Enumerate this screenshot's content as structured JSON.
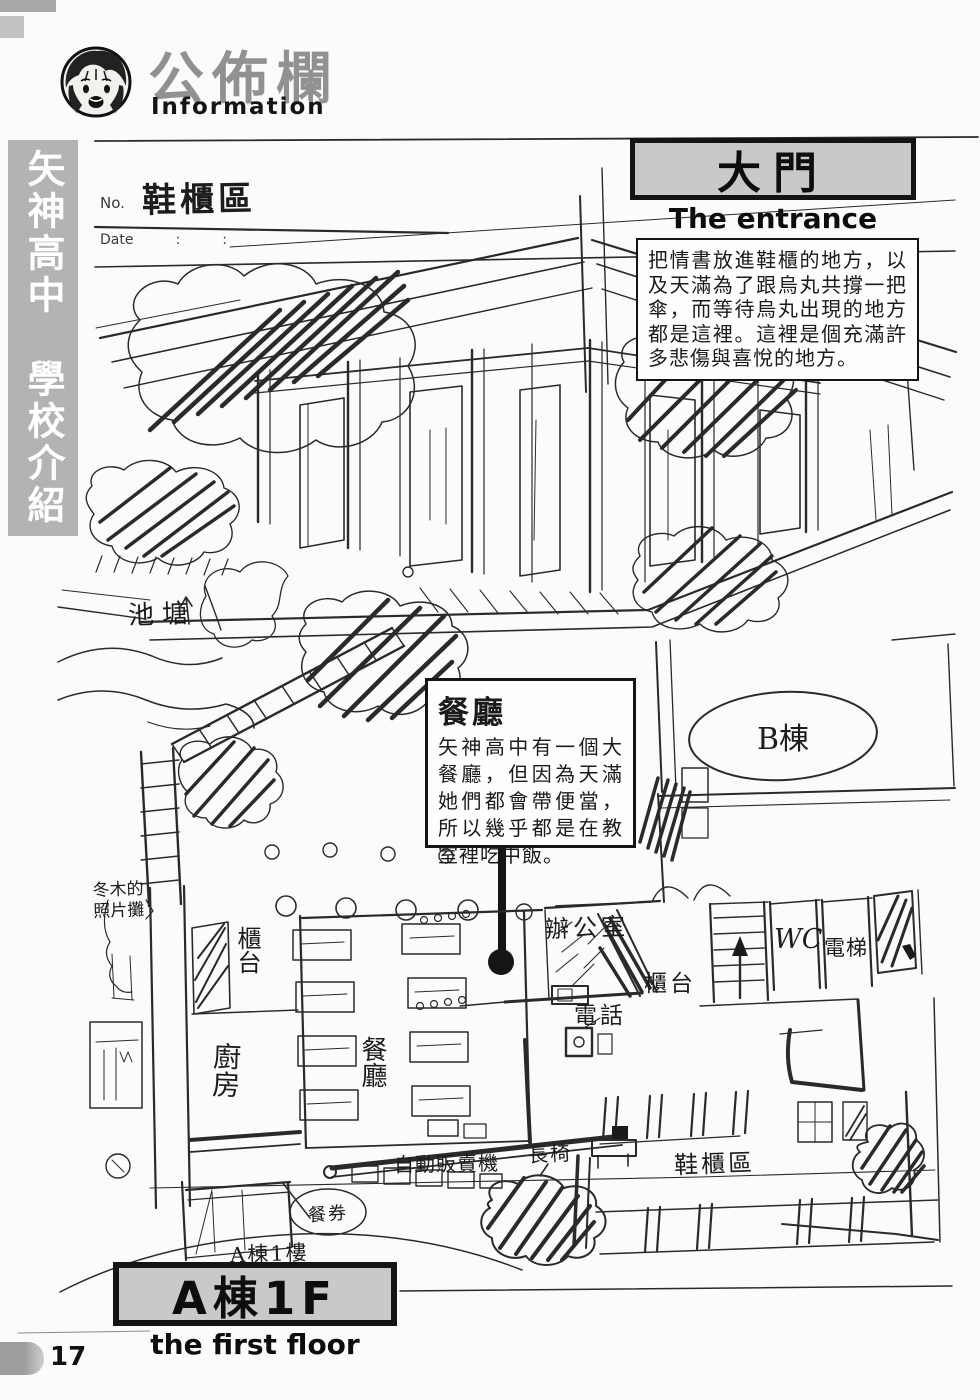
{
  "page": {
    "number": "17"
  },
  "header": {
    "title": "公佈欄",
    "subtitle": "Information"
  },
  "sidebar": {
    "text": "矢神高中　學校介紹"
  },
  "notepad": {
    "no_label": "No.",
    "date_label": "Date",
    "colon": ":",
    "area_label": "鞋櫃區"
  },
  "entrance": {
    "title": "大門",
    "subtitle": "The entrance",
    "description": "把情書放進鞋櫃的地方，以及天滿為了跟烏丸共撐一把傘，而等待烏丸出現的地方都是這裡。這裡是個充滿許多悲傷與喜悅的地方。"
  },
  "cafeteria": {
    "title": "餐廳",
    "description": "矢神高中有一個大餐廳，但因為天滿她們都會帶便當，所以幾乎都是在教室裡吃中飯。"
  },
  "floor": {
    "title": "A棟1F",
    "subtitle": "the first floor"
  },
  "map_labels": {
    "pond": "池塘",
    "building_b": "B棟",
    "photo_stand_line1": "冬木的",
    "photo_stand_line2": "照片攤",
    "counter_left": "櫃台",
    "kitchen": "廚房",
    "cafeteria": "餐廳",
    "office": "辦公室",
    "counter_right": "櫃台",
    "telephone": "電話",
    "wc": "WC",
    "elevator": "電梯",
    "bench": "長椅",
    "vending_machine": "自動販賣機",
    "shoe_lockers": "鞋櫃區",
    "meal_ticket": "餐券",
    "building_a_1f": "A棟1樓"
  },
  "colors": {
    "box_fill": "#c9c9c9",
    "sidebar_fill": "#b3b3b3",
    "title_gray": "#919191",
    "ink": "#1b1b1b"
  }
}
